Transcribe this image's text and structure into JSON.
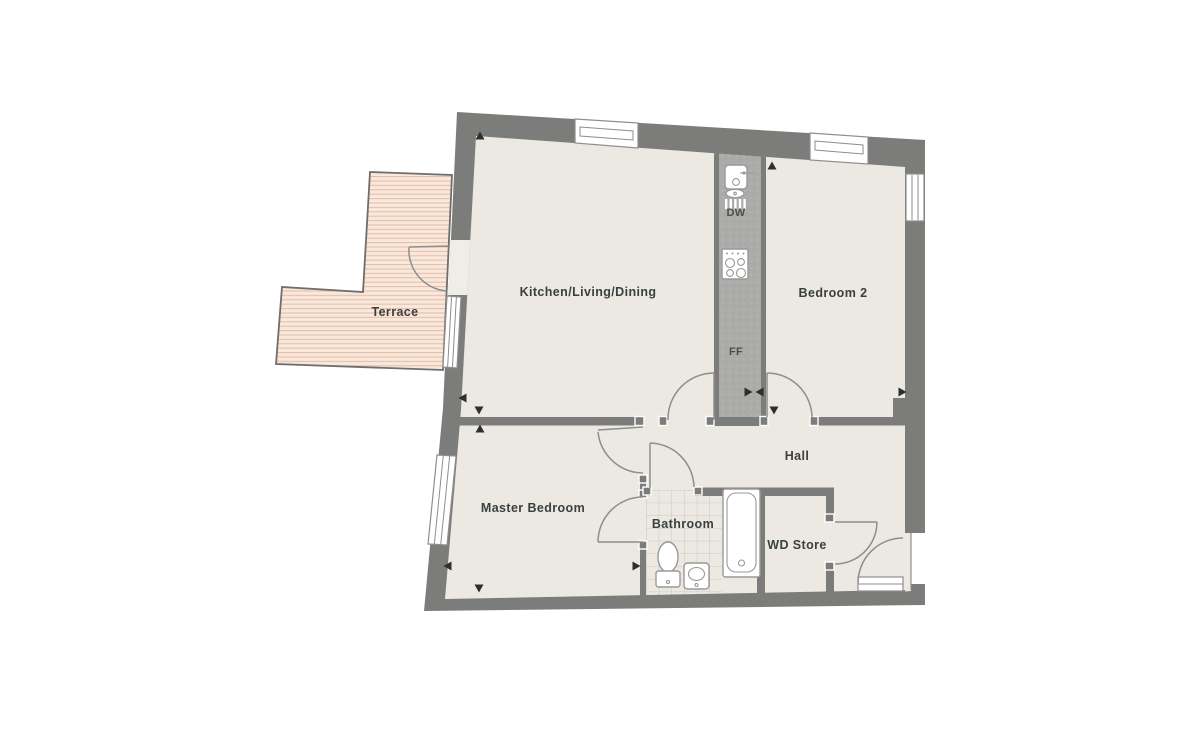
{
  "rooms": {
    "kld": {
      "label": "Kitchen/Living/Dining"
    },
    "bedroom2": {
      "label": "Bedroom 2"
    },
    "hall": {
      "label": "Hall"
    },
    "master": {
      "label": "Master Bedroom"
    },
    "bathroom": {
      "label": "Bathroom"
    },
    "wd": {
      "label": "WD Store"
    },
    "terrace": {
      "label": "Terrace"
    }
  },
  "appliances": {
    "dw": {
      "label": "DW"
    },
    "ff": {
      "label": "FF"
    }
  },
  "colors": {
    "wall": "#7c7c7a",
    "floor": "#ece9e3",
    "kitchen_strip": "#ababa9",
    "terrace_fill": "#f9e8dc",
    "terrace_line": "#e2bca6",
    "outline": "#8e8e8c",
    "label": "#3a403e"
  }
}
